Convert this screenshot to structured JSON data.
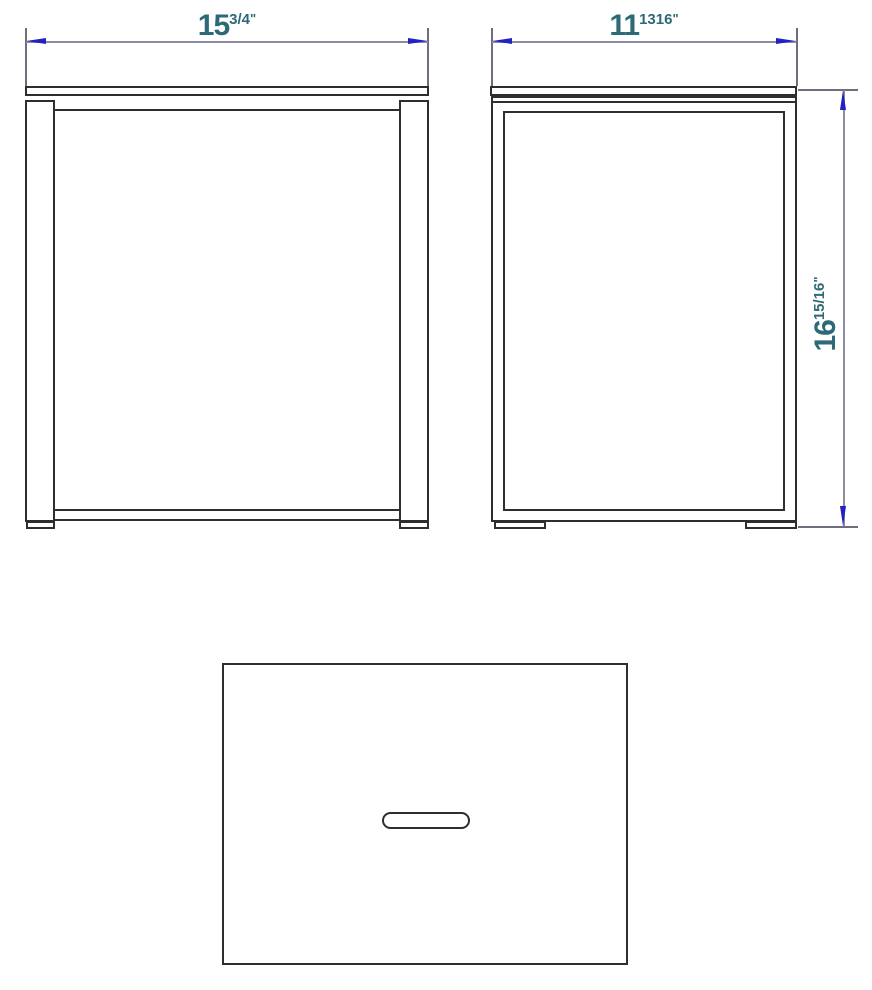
{
  "colors": {
    "line": "#2e2e2e",
    "dim_line": "#8b8ba4",
    "ext_line": "#6e6e7e",
    "arrow": "#2222c2",
    "text": "#2e6977",
    "bg": "#ffffff"
  },
  "dims": {
    "front_width": {
      "whole": "15",
      "fraction": "3/4",
      "unit": "\""
    },
    "side_depth": {
      "whole": "11",
      "fraction": "1316",
      "unit": "\""
    },
    "height": {
      "whole": "16",
      "fraction": "15/16",
      "unit": "\""
    }
  }
}
